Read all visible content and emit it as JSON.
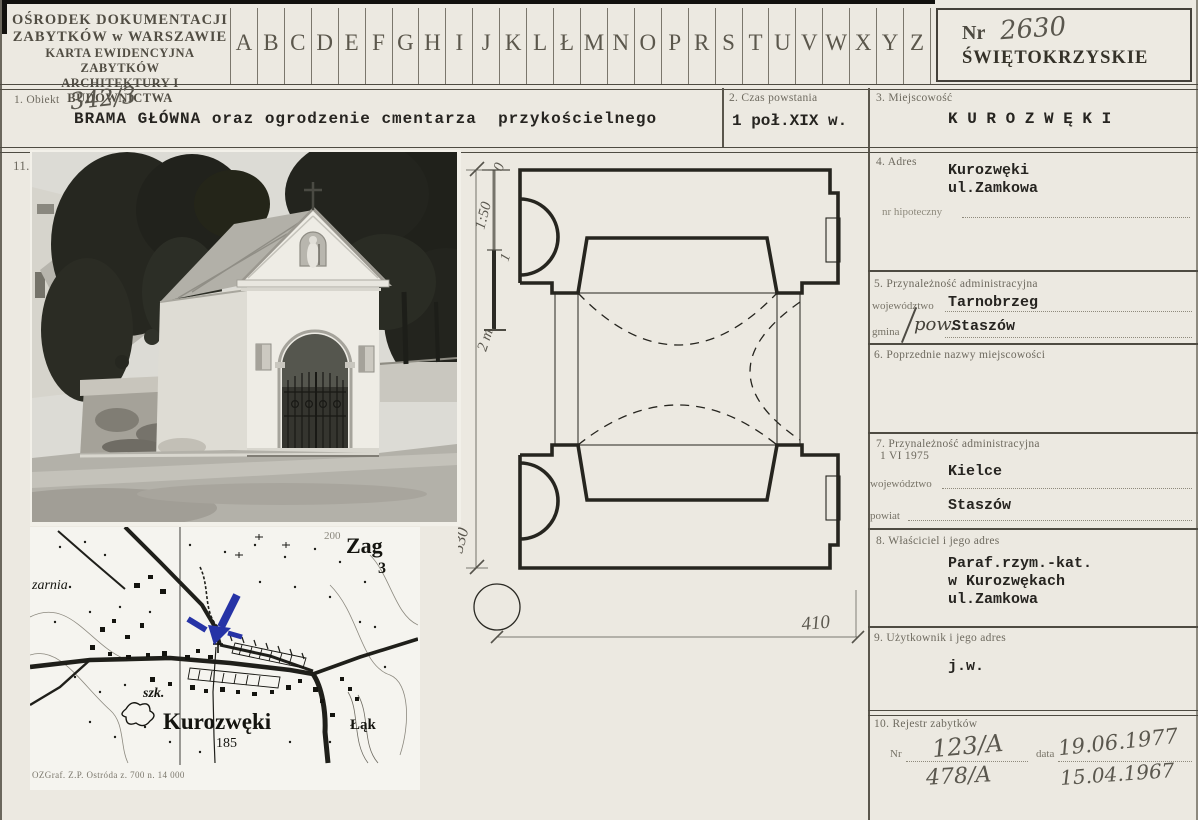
{
  "header": {
    "org1": "OŚRODEK DOKUMENTACJI",
    "org2": "ZABYTKÓW w WARSZAWIE",
    "org3": "KARTA EWIDENCYJNA ZABYTKÓW",
    "org4": "ARCHITEKTURY I BUDOWNICTWA",
    "alphabet": [
      "A",
      "B",
      "C",
      "D",
      "E",
      "F",
      "G",
      "H",
      "I",
      "J",
      "K",
      "L",
      "Ł",
      "M",
      "N",
      "O",
      "P",
      "R",
      "S",
      "T",
      "U",
      "V",
      "W",
      "X",
      "Y",
      "Z"
    ],
    "nr_label": "Nr",
    "nr_value": "2630",
    "voivodeship": "ŚWIĘTOKRZYSKIE"
  },
  "object": {
    "label": "1. Obiekt",
    "number": "342/3",
    "name": "BRAMA GŁÓWNA oraz ogrodzenie cmentarza  przykościelnego"
  },
  "time": {
    "label": "2. Czas powstania",
    "value": "1 poł.XIX w."
  },
  "place": {
    "label": "3. Miejscowość",
    "value": "K U R O Z W Ę K I"
  },
  "fields": {
    "f4": {
      "label": "4. Adres",
      "line1": "Kurozwęki",
      "line2": "ul.Zamkowa",
      "sub_label": "nr hipoteczny"
    },
    "f5": {
      "label": "5. Przynależność administracyjna",
      "woj_label": "województwo",
      "woj": "Tarnobrzeg",
      "gmina_label": "gmina",
      "gmina_hand": "pow.",
      "gmina": "Staszów"
    },
    "f6": {
      "label": "6. Poprzednie nazwy miejscowości"
    },
    "f7": {
      "label": "7. Przynależność administracyjna",
      "label2": "1 VI 1975",
      "woj_label": "województwo",
      "woj": "Kielce",
      "pow_label": "powiat",
      "pow": "Staszów"
    },
    "f8": {
      "label": "8. Właściciel i jego adres",
      "line1": "Paraf.rzym.-kat.",
      "line2": "w Kurozwękach",
      "line3": "ul.Zamkowa"
    },
    "f9": {
      "label": "9. Użytkownik i jego adres",
      "value": "j.w."
    },
    "f10": {
      "label": "10. Rejestr zabytków",
      "nr_label": "Nr",
      "nr_value": "123/A",
      "nr_value2": "478/A",
      "date_label": "data",
      "date_value": "19.06.1977",
      "date_value2": "15.04.1967"
    }
  },
  "photo": {
    "index_label": "11."
  },
  "plan": {
    "scale_zero": "0",
    "scale_label": "1:50",
    "scale_one": "1",
    "scale_two": "2 m.",
    "dim_height": "530",
    "dim_width": "410"
  },
  "map": {
    "labels": {
      "zarnia": "zarnia",
      "zag": "Zag",
      "num3": "3",
      "contour": "200",
      "szk": "szk.",
      "town": "Kurozwęki",
      "elev": "185",
      "lak": "Łąk"
    },
    "caption": "OZGraf. Z.P. Ostróda z. 700 n. 14 000",
    "arrow_color": "#2633a6"
  }
}
